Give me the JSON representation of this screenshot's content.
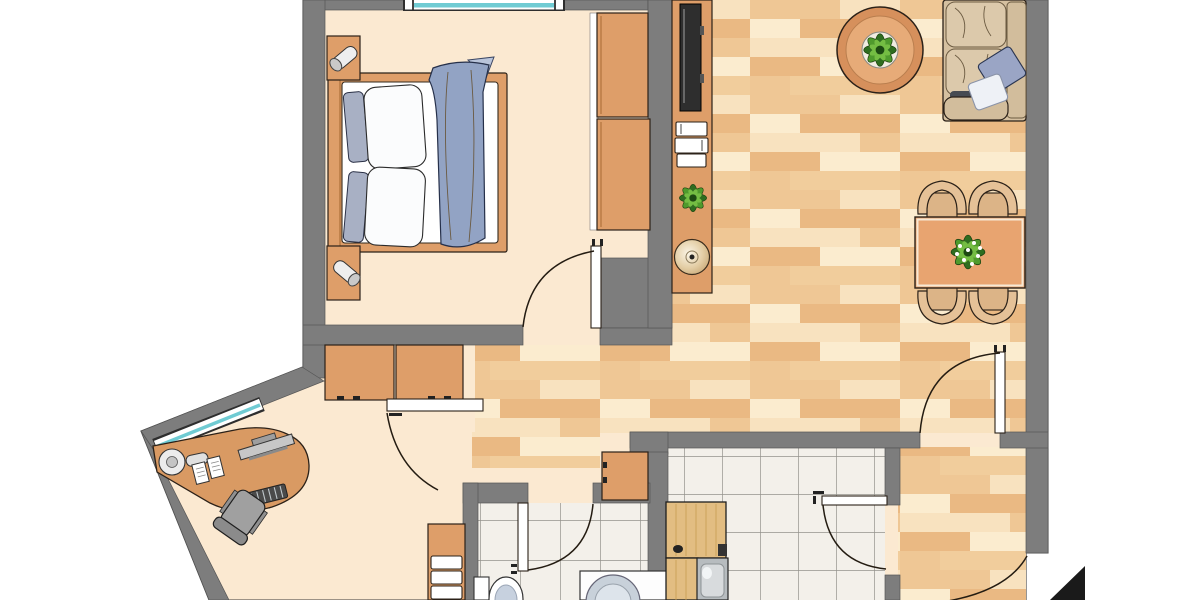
{
  "plan": {
    "type": "apartment-floor-plan",
    "rooms": {
      "bedroom": {
        "furniture": [
          "double-bed",
          "pillows",
          "duvet",
          "nightstand-top",
          "nightstand-bottom",
          "table-lamp",
          "wardrobe-two-sections"
        ],
        "windows": 1,
        "doors": 1
      },
      "living_dining_room": {
        "furniture": [
          "corner-sofa",
          "sofa-pillows",
          "round-coffee-table",
          "potted-plant",
          "sideboard",
          "tv-panel",
          "book-stack",
          "decorative-disc",
          "dining-table",
          "dining-chairs-x4",
          "table-plant-centerpiece"
        ],
        "doors": 1
      },
      "hallway": {
        "furniture": [
          "wall-cabinets-x2",
          "slatted-shelf-cabinet",
          "small-cabinet"
        ],
        "doors": 1
      },
      "office_nook": {
        "furniture": [
          "corner-desk",
          "desk-lamp",
          "monitor",
          "keyboard",
          "papers-x2",
          "office-chair"
        ],
        "windows": 1
      },
      "bathroom": {
        "furniture": [
          "toilet",
          "washing-machine"
        ],
        "doors": 1,
        "floor": "tile"
      },
      "kitchen": {
        "furniture": [
          "kitchen-counter",
          "sink",
          "hob-item"
        ],
        "doors": 1,
        "floor": "tile"
      },
      "entrance": {
        "markers": [
          "entrance-door-swing",
          "entrance-arrow-triangle"
        ]
      }
    },
    "counts": {
      "windows": 2,
      "door_swings": 7,
      "plants": 4,
      "dining_chairs": 4
    }
  },
  "colors": {
    "wall_gray": "#7d7d7d",
    "floor_cream": "#fbe9d1",
    "wood_base": "#f4d4a6",
    "wood_base2": "#f1cd9c",
    "wood_a": "#efc795",
    "wood_b": "#f8e2bf",
    "wood_c": "#fbeccf",
    "wood_d": "#eab983",
    "tile_fill": "#f3f0ea",
    "tile_line": "#94928c",
    "furn_wood": "#de9e69",
    "counter_wood": "#e2bd82",
    "sofa_tan": "#d5c0a0",
    "duvet_blue": "#92a3c4",
    "pillow_gray": "#a8b0c4",
    "pillow_blue": "#9aa5c5",
    "glass_teal": "#6fcbd3",
    "table_orange": "#e8a470",
    "coffee_table_rim": "#d6905c",
    "coffee_table_top": "#e7ab78",
    "chair_back_tan": "#e5c197",
    "chair_seat_tan": "#dcb487",
    "office_chair_gray": "#a0a0a0",
    "plant_dark": "#2f6d20",
    "plant_mid": "#4f9a2d",
    "plant_light": "#74bd43",
    "washer_drum": "#c8d1da",
    "toilet_bowl": "#c7d1df",
    "black": "#1a1a1a",
    "white": "#ffffff"
  }
}
